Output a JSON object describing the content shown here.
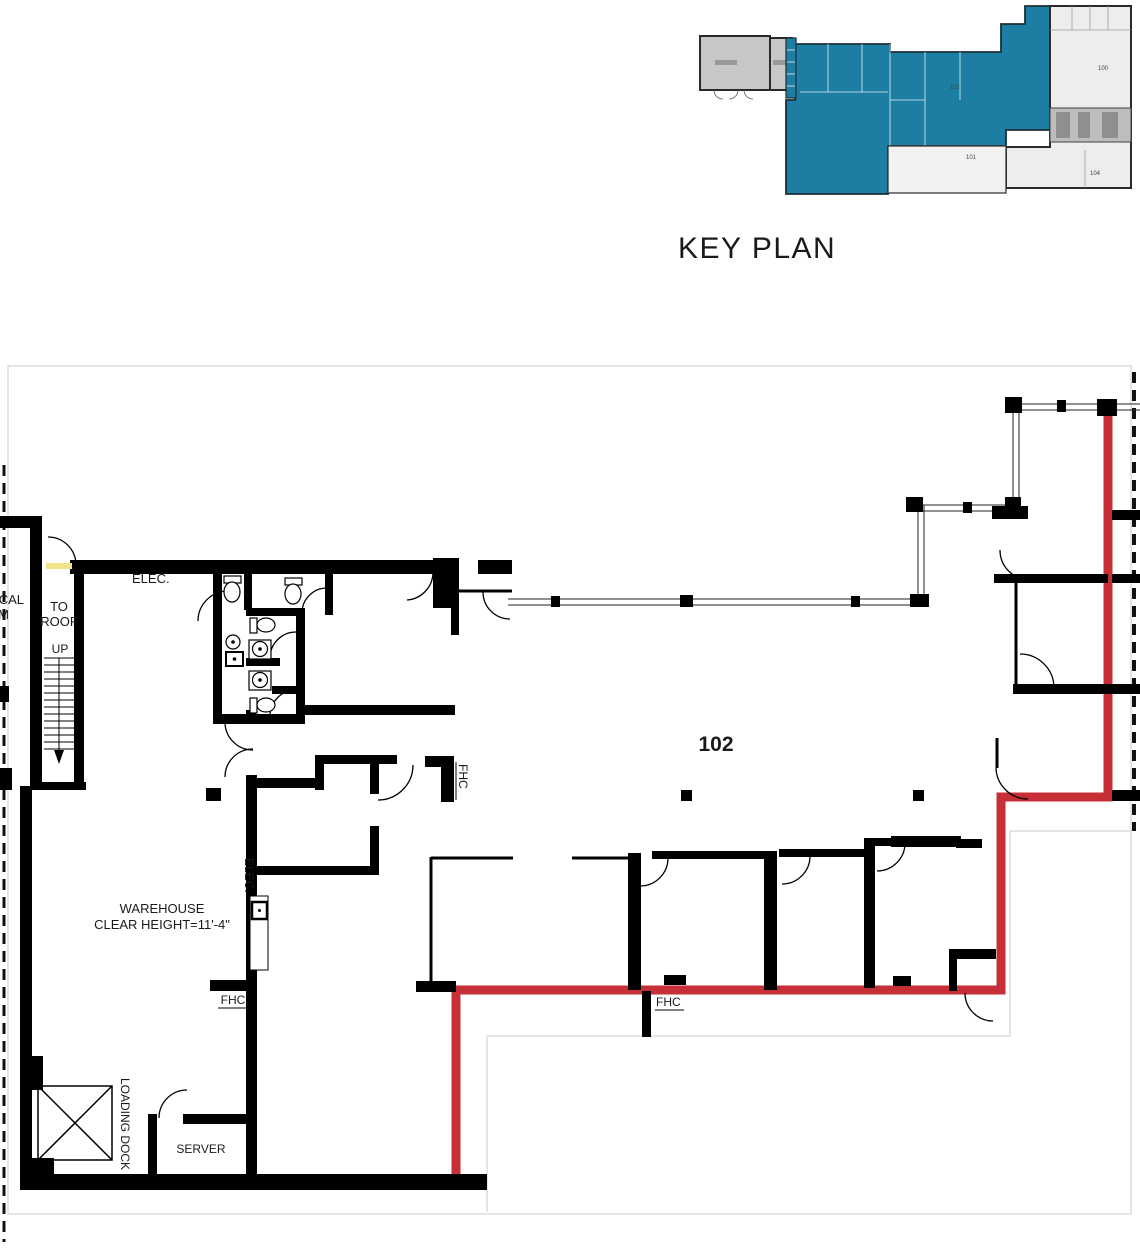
{
  "key_plan": {
    "title": "KEY PLAN",
    "rooms": {
      "suite": "102",
      "r100": "100",
      "r101": "101",
      "r104": "104"
    }
  },
  "floor_plan": {
    "suite_number": "102",
    "labels": {
      "elec_room": "ELEC.",
      "to_roof_1": "TO",
      "to_roof_2": "ROOF",
      "up": "UP",
      "edge_cut_1": "CAL",
      "edge_cut_2": "M",
      "warehouse_1": "WAREHOUSE",
      "warehouse_2": "CLEAR HEIGHT=11'-4\"",
      "elec_vertical": "ELEC.",
      "fhc_a": "FHC",
      "fhc_b": "FHC",
      "fhc_c": "FHC",
      "loading_dock": "LOADING DOCK",
      "server": "SERVER"
    },
    "colors": {
      "suite_highlight": "#c62f36",
      "key_plan_highlight": "#1d7ea3",
      "door_highlight": "#f2e28c",
      "title_text": "#2d87a8"
    }
  }
}
